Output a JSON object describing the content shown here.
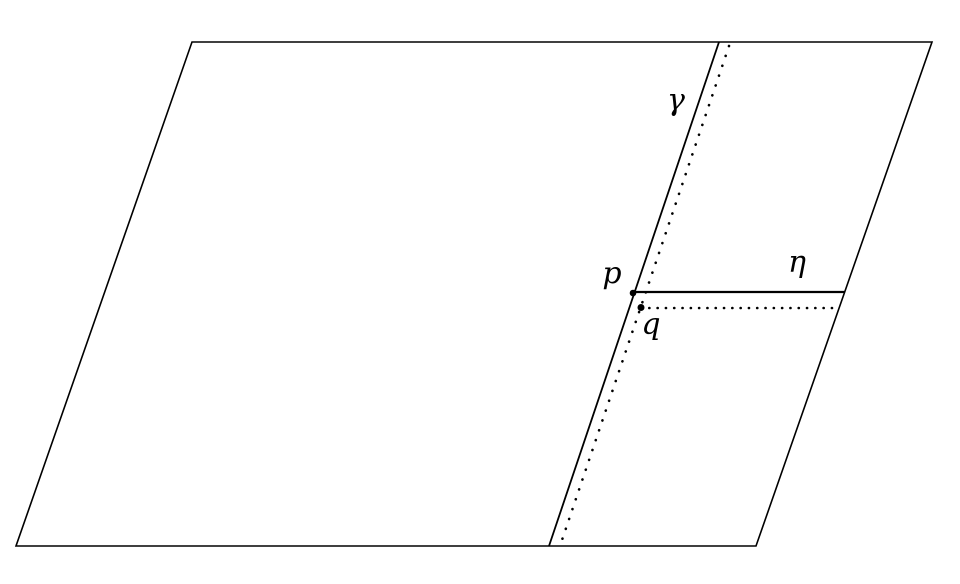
{
  "diagram": {
    "type": "geometry-figure",
    "description": "A parallelogram crossed by a slanted solid line labeled gamma with a dotted line parallel to it, and a horizontal solid line labeled eta with a dotted line parallel to it; point p marks the intersection of gamma and eta, point q marks the intersection of the two dotted lines.",
    "background_color": "#ffffff",
    "stroke_color": "#000000",
    "shape": "parallelogram",
    "labels": {
      "gamma": "γ",
      "eta": "η",
      "point_p": "p",
      "point_q": "q"
    },
    "lines": [
      {
        "name": "gamma",
        "style": "solid",
        "label": "γ",
        "orientation": "slanted, parallel to left and right sides, from top edge to bottom edge"
      },
      {
        "name": "gamma-parallel",
        "style": "dotted",
        "label": "",
        "orientation": "slanted, just right of gamma, from top edge to bottom edge"
      },
      {
        "name": "eta",
        "style": "solid",
        "label": "η",
        "orientation": "horizontal, from point p to the right edge"
      },
      {
        "name": "eta-parallel",
        "style": "dotted",
        "label": "",
        "orientation": "horizontal, just below eta, from point q to the right edge"
      }
    ],
    "points": [
      {
        "name": "p",
        "marker": "filled-dot",
        "location": "intersection of gamma and eta"
      },
      {
        "name": "q",
        "marker": "filled-dot",
        "location": "intersection of the two dotted lines"
      }
    ]
  }
}
